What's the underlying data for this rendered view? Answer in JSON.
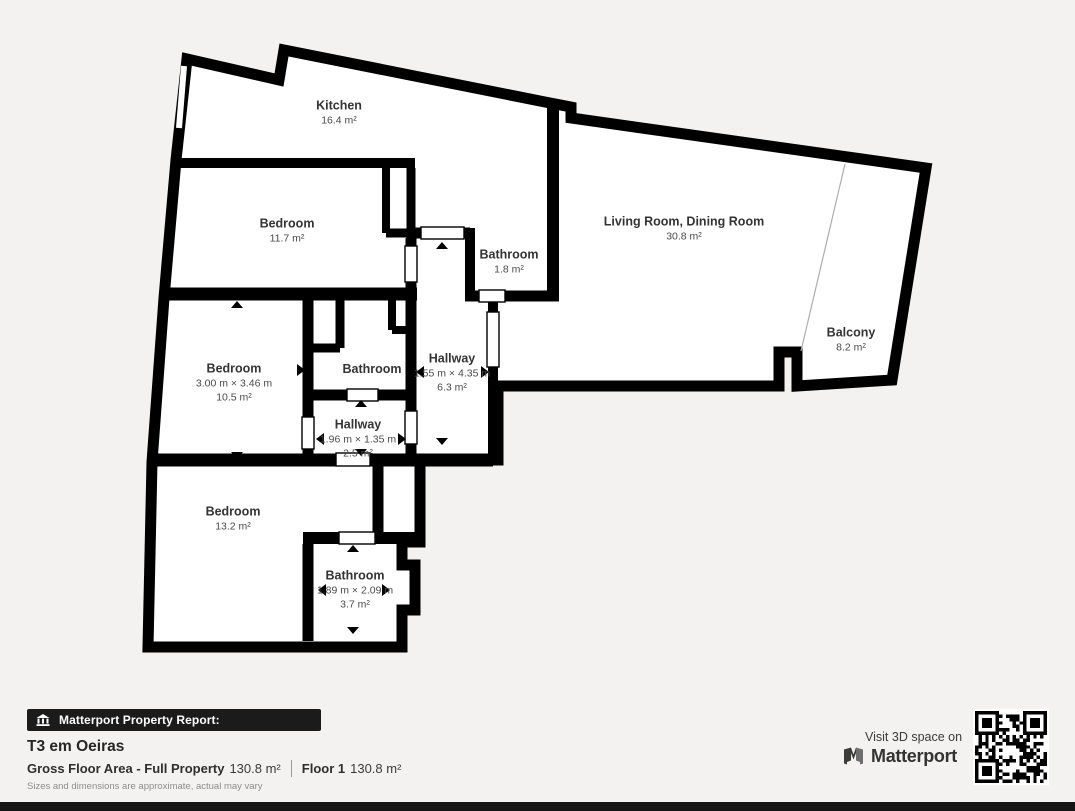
{
  "rooms": [
    {
      "name": "Kitchen",
      "area": "16.4 m²"
    },
    {
      "name": "Bedroom",
      "area": "11.7 m²"
    },
    {
      "name": "Living Room, Dining Room",
      "area": "30.8 m²"
    },
    {
      "name": "Bathroom",
      "area": "1.8 m²"
    },
    {
      "name": "Bedroom",
      "dims": "3.00 m × 3.46 m",
      "area": "10.5 m²"
    },
    {
      "name": "Bathroom"
    },
    {
      "name": "Hallway",
      "dims": "1.55 m × 4.35 m",
      "area": "6.3 m²"
    },
    {
      "name": "Balcony",
      "area": "8.2 m²"
    },
    {
      "name": "Hallway",
      "dims": "1.96 m × 1.35 m",
      "area": "2.5 m²"
    },
    {
      "name": "Bedroom",
      "area": "13.2 m²"
    },
    {
      "name": "Bathroom",
      "dims": "1.89 m × 2.09 m",
      "area": "3.7 m²"
    }
  ],
  "footer": {
    "report_badge": "Matterport Property Report:",
    "property_title": "T3 em Oeiras",
    "gross_label": "Gross Floor Area - Full Property",
    "gross_value": "130.8 m²",
    "floor_label": "Floor 1",
    "floor_value": "130.8 m²",
    "disclaimer": "Sizes and dimensions are approximate, actual may vary",
    "visit_text": "Visit 3D space on",
    "brand": "Matterport"
  },
  "colors": {
    "wall": "#000000",
    "floor": "#ffffff",
    "background": "#f3f2f0",
    "label_text": "#3c3c3c"
  }
}
